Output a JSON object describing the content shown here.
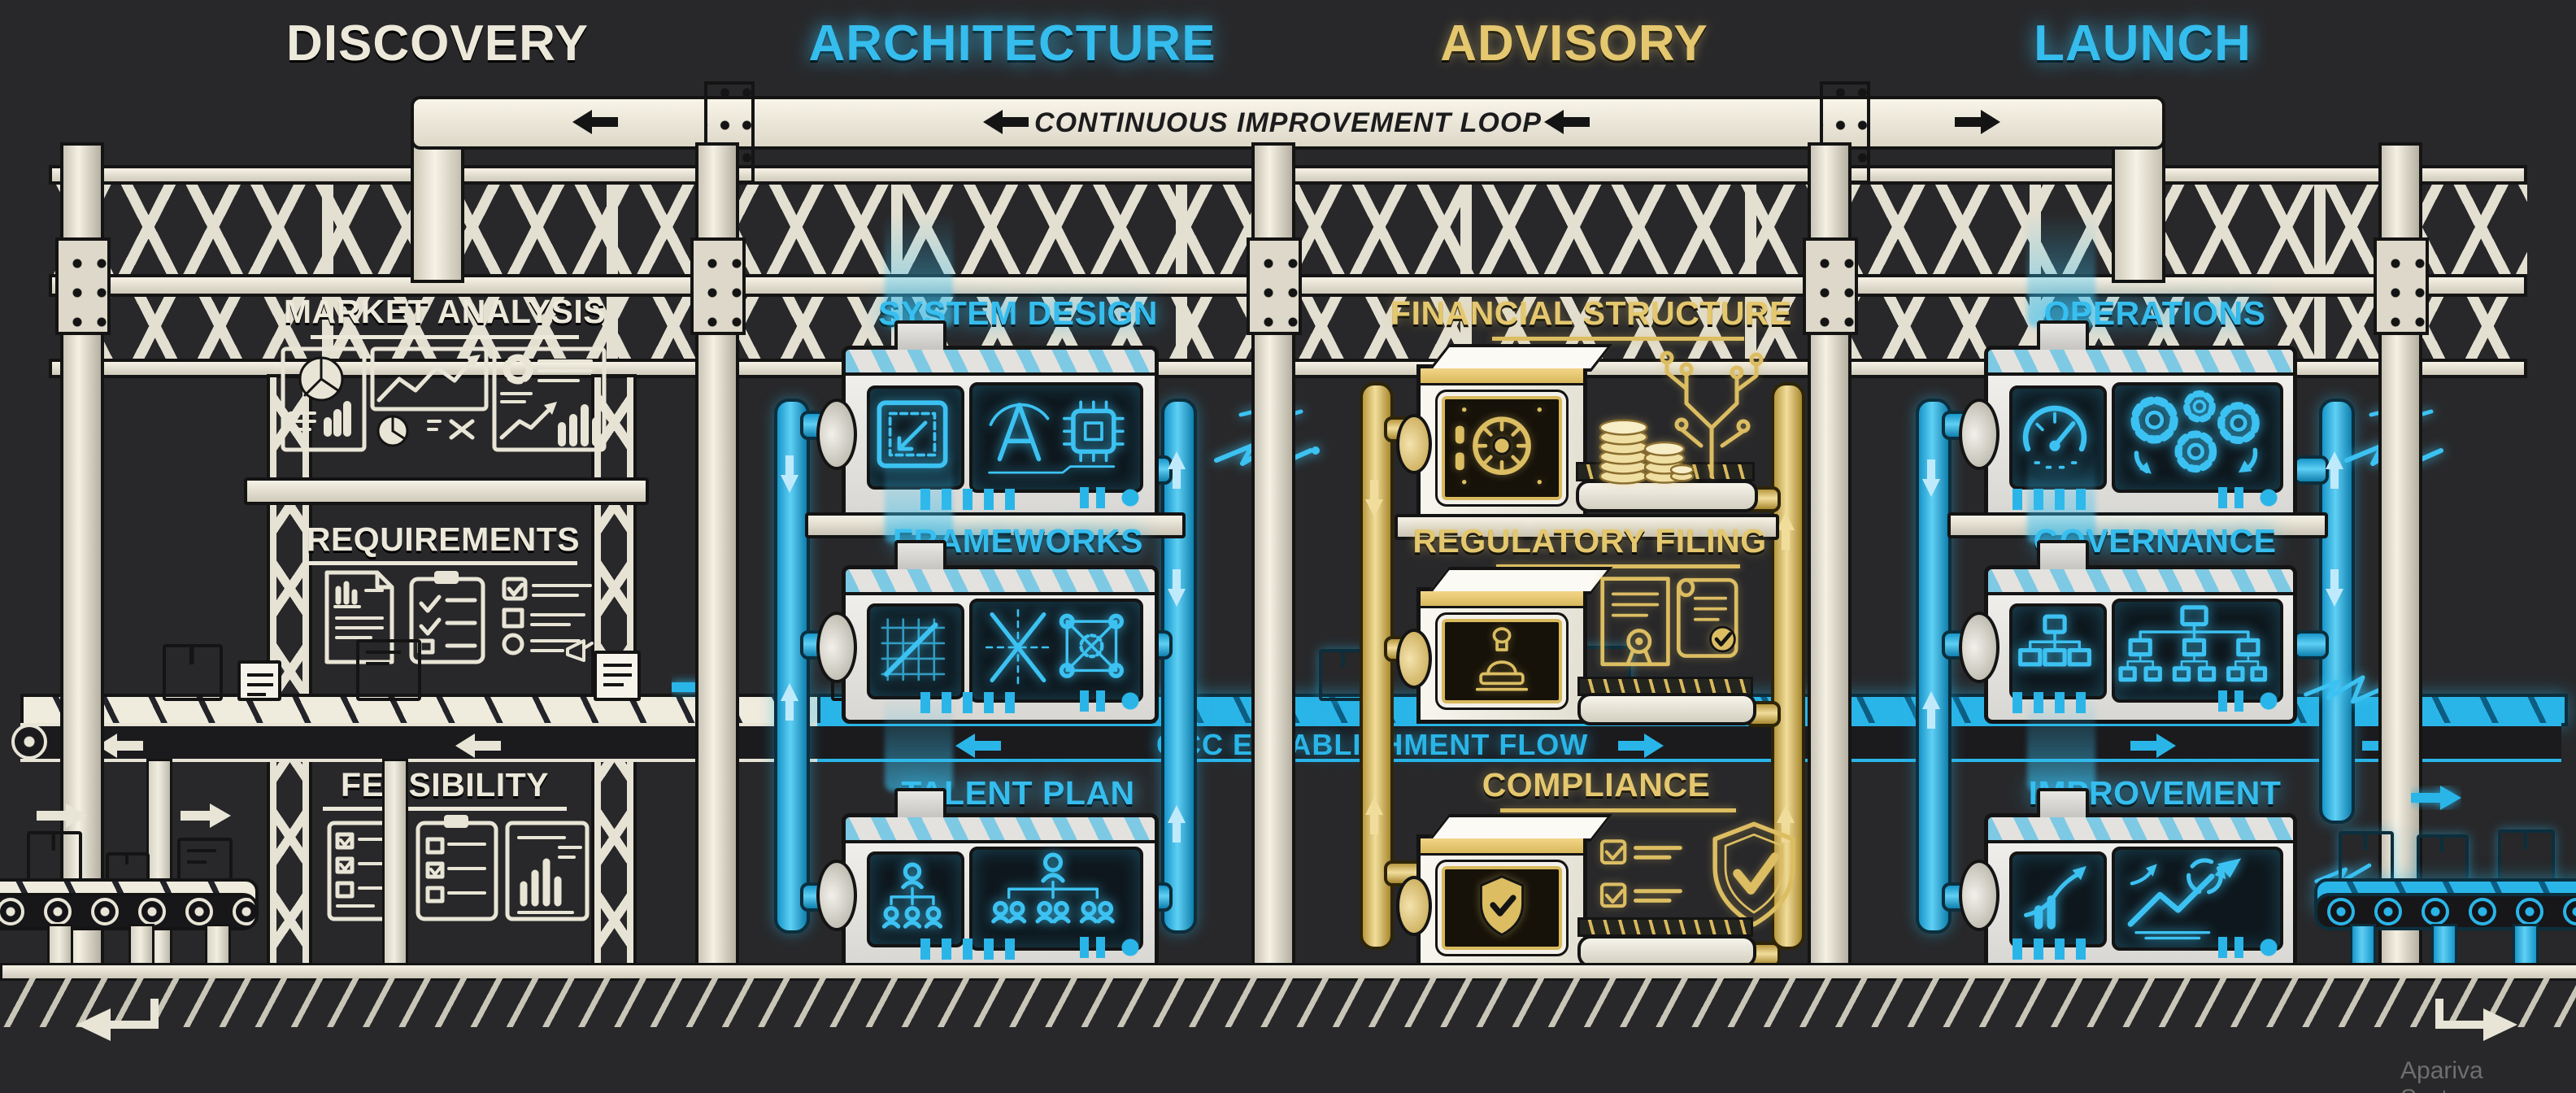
{
  "phases": [
    {
      "label": "DISCOVERY",
      "color": "#ece8da"
    },
    {
      "label": "ARCHITECTURE",
      "color": "#35bdee"
    },
    {
      "label": "ADVISORY",
      "color": "#e4c76e"
    },
    {
      "label": "LAUNCH",
      "color": "#35bdee"
    }
  ],
  "banner": {
    "label": "CONTINUOUS IMPROVEMENT LOOP"
  },
  "conveyor": {
    "label": "GCC ESTABLISHMENT FLOW"
  },
  "discovery": {
    "stations": [
      {
        "title": "MARKET ANALYSIS",
        "icons": [
          "pie-chart-icon",
          "line-chart-icon",
          "donut-bar-chart-icon"
        ]
      },
      {
        "title": "REQUIREMENTS",
        "icons": [
          "document-icon",
          "clipboard-check-icon",
          "checklist-icon"
        ]
      },
      {
        "title": "FEASIBILITY",
        "icons": [
          "checklist-card-icon",
          "clipboard-icon",
          "bar-report-icon"
        ]
      }
    ]
  },
  "architecture": {
    "stations": [
      {
        "title": "SYSTEM DESIGN",
        "icons": [
          "blueprint-icon",
          "compass-icon",
          "chip-icon"
        ]
      },
      {
        "title": "FRAMEWORKS",
        "icons": [
          "grid-graph-icon",
          "x-diagram-icon",
          "node-graph-icon"
        ]
      },
      {
        "title": "TALENT PLAN",
        "icons": [
          "org-chart-icon",
          "team-hierarchy-icon"
        ]
      }
    ]
  },
  "advisory": {
    "stations": [
      {
        "title": "FINANCIAL STRUCTURE",
        "icons": [
          "vault-icon",
          "coins-icon",
          "circuit-icon"
        ]
      },
      {
        "title": "REGULATORY FILING",
        "icons": [
          "stamp-icon",
          "certificate-icon",
          "scroll-check-icon"
        ]
      },
      {
        "title": "COMPLIANCE",
        "icons": [
          "shield-check-icon",
          "checklist-icon",
          "shield-outline-icon"
        ]
      }
    ]
  },
  "launch": {
    "stations": [
      {
        "title": "OPERATIONS",
        "icons": [
          "gauge-icon",
          "gears-icon"
        ]
      },
      {
        "title": "GOVERNANCE",
        "icons": [
          "org-chart-icon",
          "org-tree-icon"
        ]
      },
      {
        "title": "IMPROVEMENT",
        "icons": [
          "growth-arrow-icon",
          "cycle-growth-icon"
        ]
      }
    ]
  },
  "watermark": "Apariva Systems",
  "colors": {
    "background": "#28282a",
    "cream": "#ece8da",
    "blue": "#2ab5e8",
    "gold": "#dcbd62",
    "band_dark": "#1b1b1e",
    "outline": "#141414"
  }
}
